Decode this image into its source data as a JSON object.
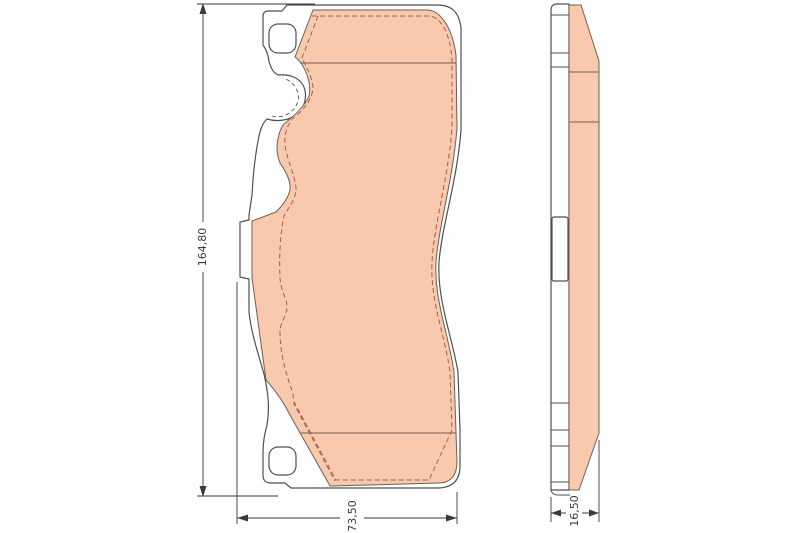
{
  "dimensions": {
    "height": "164,80",
    "width": "73,50",
    "thickness": "16,50"
  },
  "colors": {
    "background": "#ffffff",
    "plate_fill": "#ffffff",
    "friction": "#f9c9ae",
    "outline": "#4f4f4f",
    "hidden": "#9c6250",
    "chamfer": "#6f5f52",
    "dimension": "#3a3a3a"
  }
}
